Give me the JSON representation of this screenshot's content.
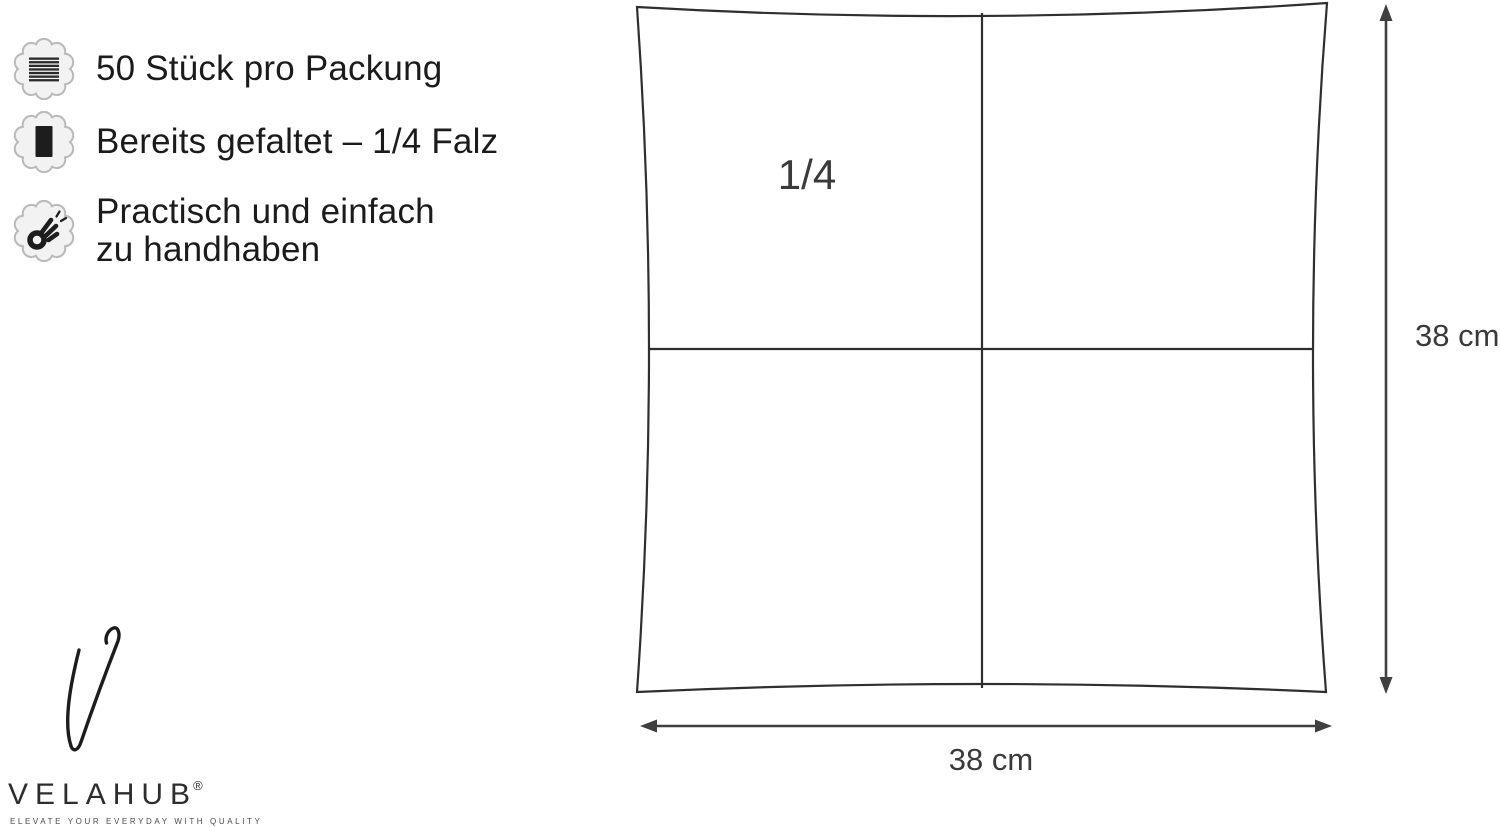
{
  "features": {
    "items": [
      {
        "icon": "napkin-stack-icon",
        "label": "50 Stück pro Packung"
      },
      {
        "icon": "folded-napkin-icon",
        "label": "Bereits gefaltet – 1/4 Falz"
      },
      {
        "icon": "ok-hand-icon",
        "line1": "Practisch und einfach",
        "line2": "zu handhaben"
      }
    ]
  },
  "diagram": {
    "quadrant_label": "1/4",
    "height_label": "38 cm",
    "width_label": "38 cm"
  },
  "brand": {
    "name": "VELAHUB",
    "registered": "®",
    "tagline": "ELEVATE YOUR EVERYDAY WITH QUALITY"
  },
  "colors": {
    "text": "#1b1b1b",
    "diagram_line": "#333333",
    "dimension": "#3a3a3a",
    "badge_fill": "#f2f2f2",
    "badge_border": "#b9b9b9",
    "icon_glyph": "#1d1d1d"
  }
}
